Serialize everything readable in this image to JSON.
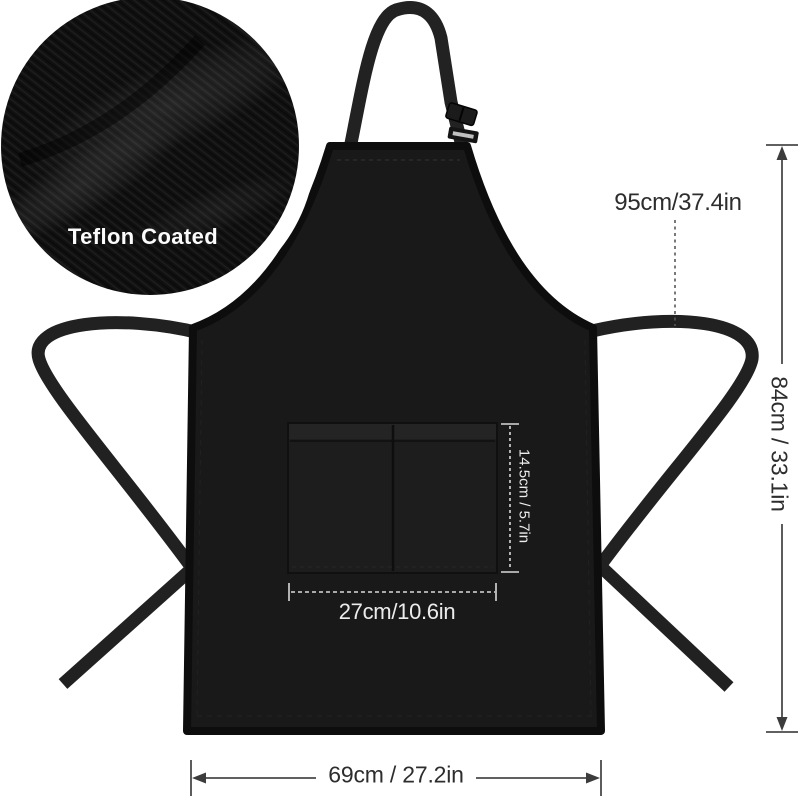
{
  "inset": {
    "caption": "Teflon Coated"
  },
  "dimensions": {
    "neck_strap_length": "95cm/37.4in",
    "apron_height": "84cm / 33.1in",
    "pocket_depth": "14.5cm / 5.7in",
    "pocket_width": "27cm/10.6in",
    "apron_width": "69cm / 27.2in"
  },
  "colors": {
    "background": "#ffffff",
    "apron_body": "#191919",
    "apron_binding": "#0d0d0d",
    "strap": "#212121",
    "pocket": "#1d1d1d",
    "pocket_hem": "#242424",
    "inset_fabric": "#111111",
    "inset_ring": "#ffffff",
    "dark_measure_line": "#4a4a4a",
    "light_measure_line": "#d9d9d9",
    "dark_label_text": "#2d2d2d",
    "light_label_text": "#ececec",
    "buckle_metal_glint": "#c0c0c0"
  }
}
